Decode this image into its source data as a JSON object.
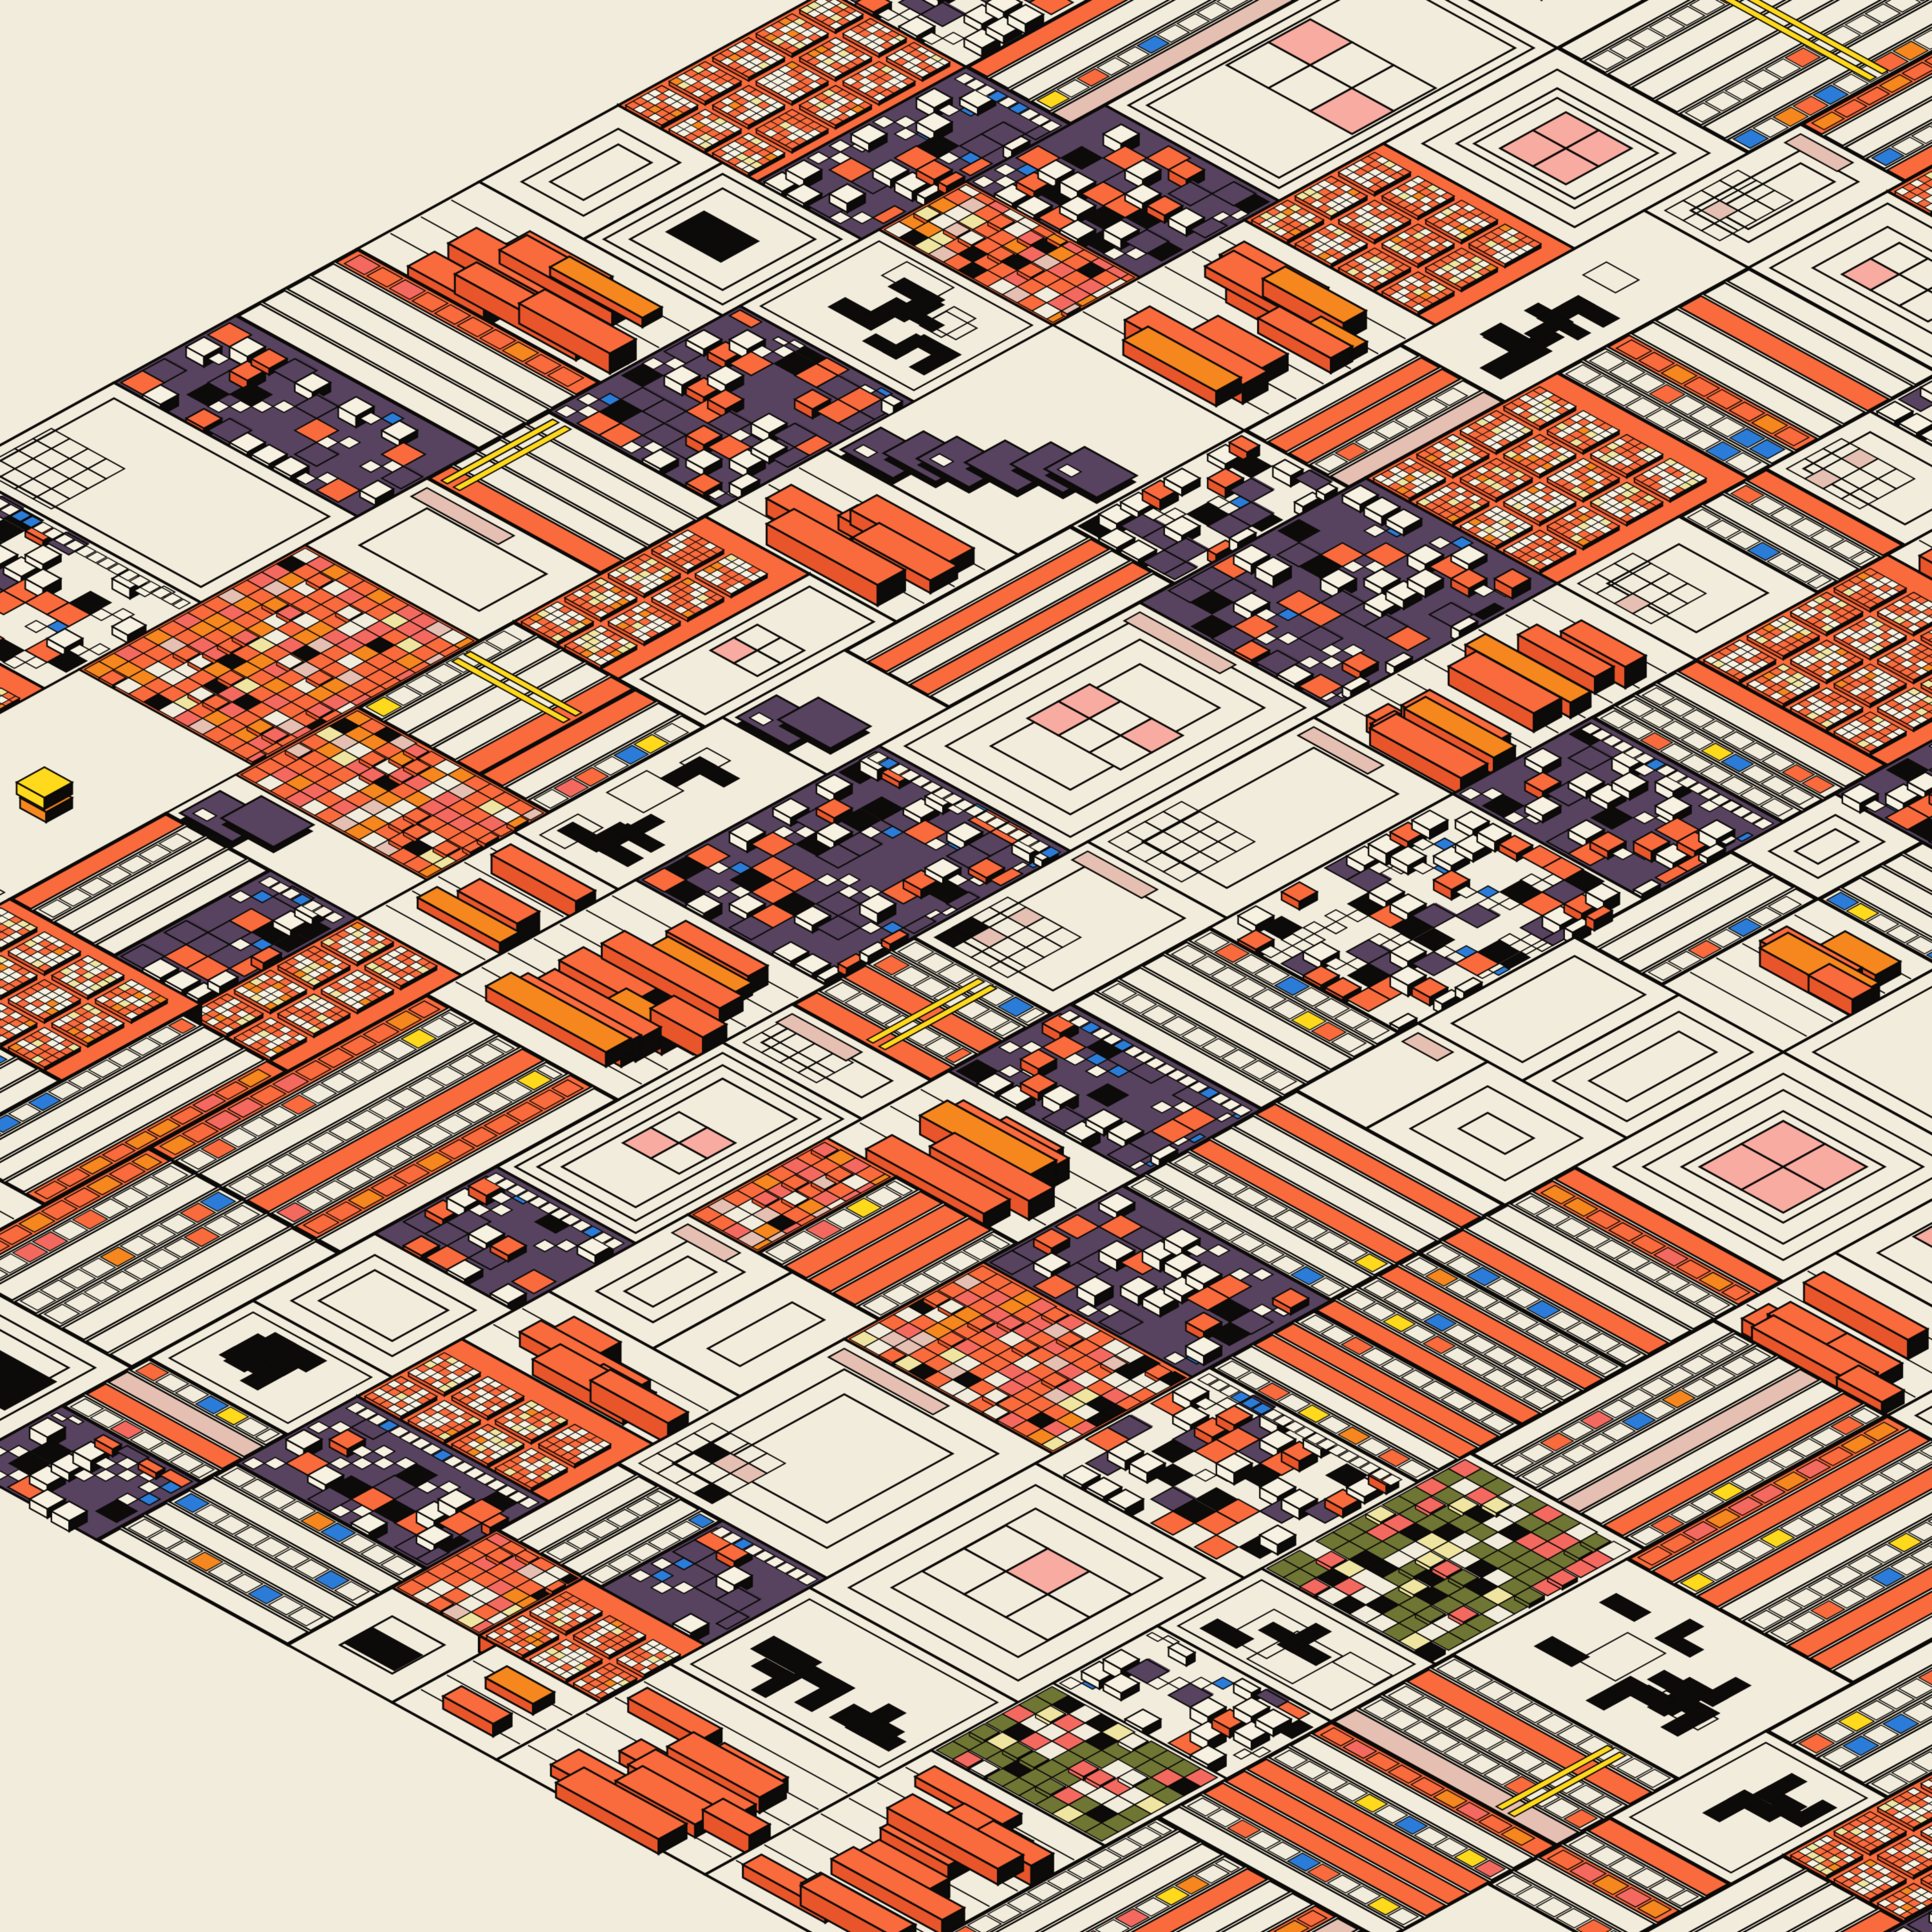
{
  "artwork": {
    "kind": "isometric-generative-cityscape",
    "params": {
      "size": 3000,
      "cell": 27,
      "slope": 0.55,
      "domain": 110,
      "seed": 911,
      "stroke_width": 3.5
    },
    "palette": {
      "background": "#F2ECDC",
      "cream": "#F2ECDC",
      "cream_bright": "#F7F1E2",
      "ink": "#0D0B09",
      "orange": "#F96A3C",
      "orange_deep": "#E8552A",
      "amber": "#F5871E",
      "salmon": "#F4695F",
      "pink": "#F8ABA0",
      "pink_dusty": "#E5C0B2",
      "purple": "#57435F",
      "purple_deep": "#4A3852",
      "blue": "#2B7CD8",
      "yellow": "#FFD91C",
      "pale_yellow": "#F0E5A0",
      "olive": "#6F7634"
    },
    "pattern_weights": {
      "plaza": 17,
      "stripes": 20,
      "dense": 10,
      "checker": 16,
      "slabs": 12,
      "black_l": 8,
      "small_grid": 7,
      "olive_grid": 2.5,
      "cascade": 5.5,
      "accent": 1.5
    }
  }
}
